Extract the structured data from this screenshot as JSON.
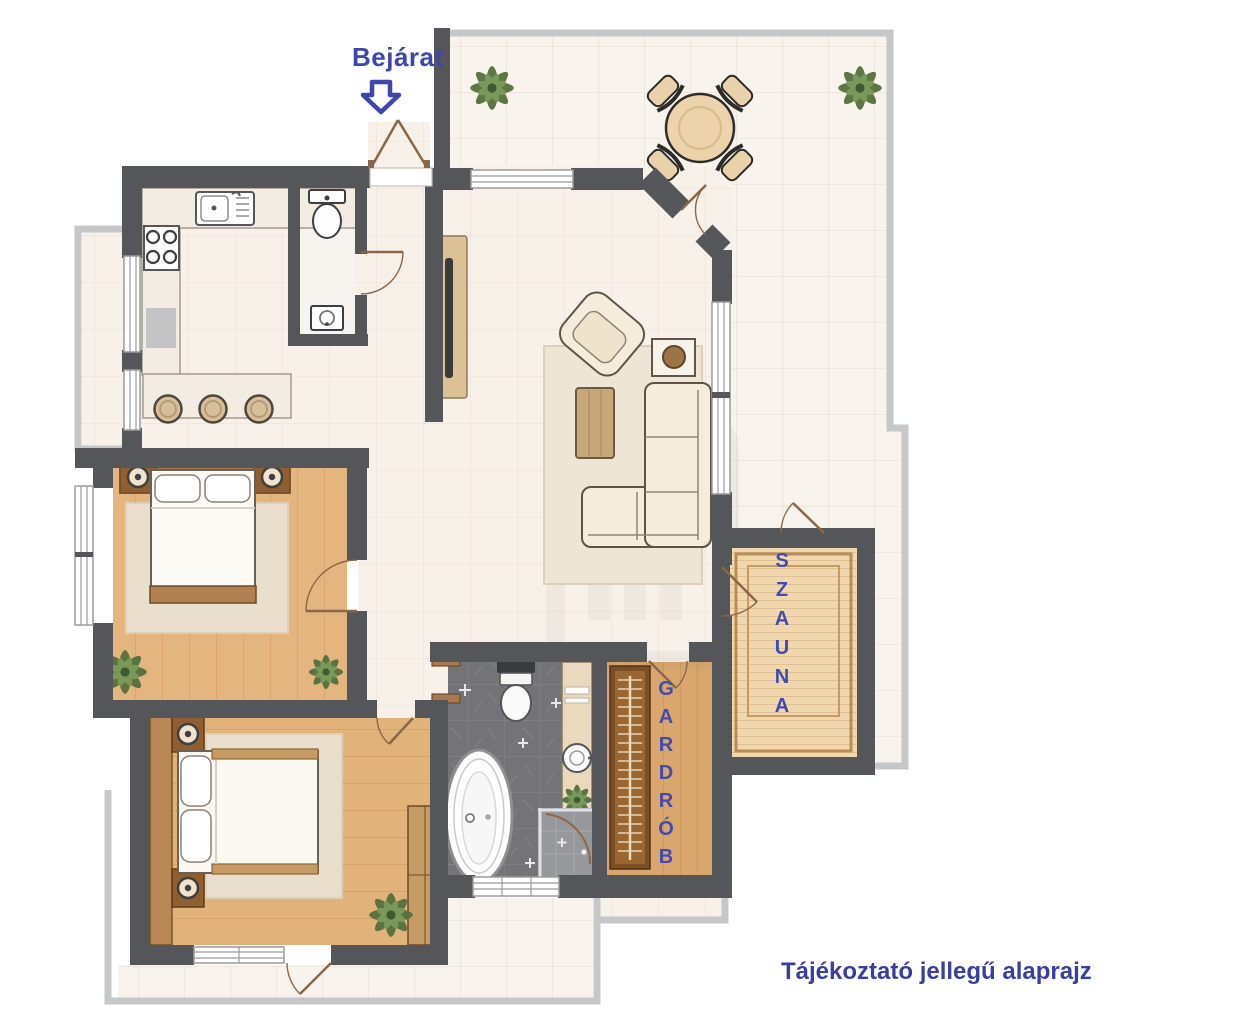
{
  "labels": {
    "entrance": "Bejárat",
    "sauna": "SZAUNA",
    "wardrobe": "GARDRÓB",
    "disclaimer": "Tájékoztató jellegű alaprajz"
  },
  "icons": {
    "entrance_arrow": "down-arrow-icon"
  },
  "colors": {
    "label_blue": "#3e45ad",
    "wall_dark": "#55565a",
    "terrace_tile": "#f8f3ec",
    "interior_floor": "#f7f1ea",
    "bedroom_wood": "#e4b57f",
    "wardrobe_wood": "#d9a76e",
    "sauna_wood": "#f0d7ad",
    "bathroom_tile": "#747377",
    "railing_gray": "#c6c7c9",
    "door_wood": "#8a6748",
    "plant_green": "#55703c"
  }
}
